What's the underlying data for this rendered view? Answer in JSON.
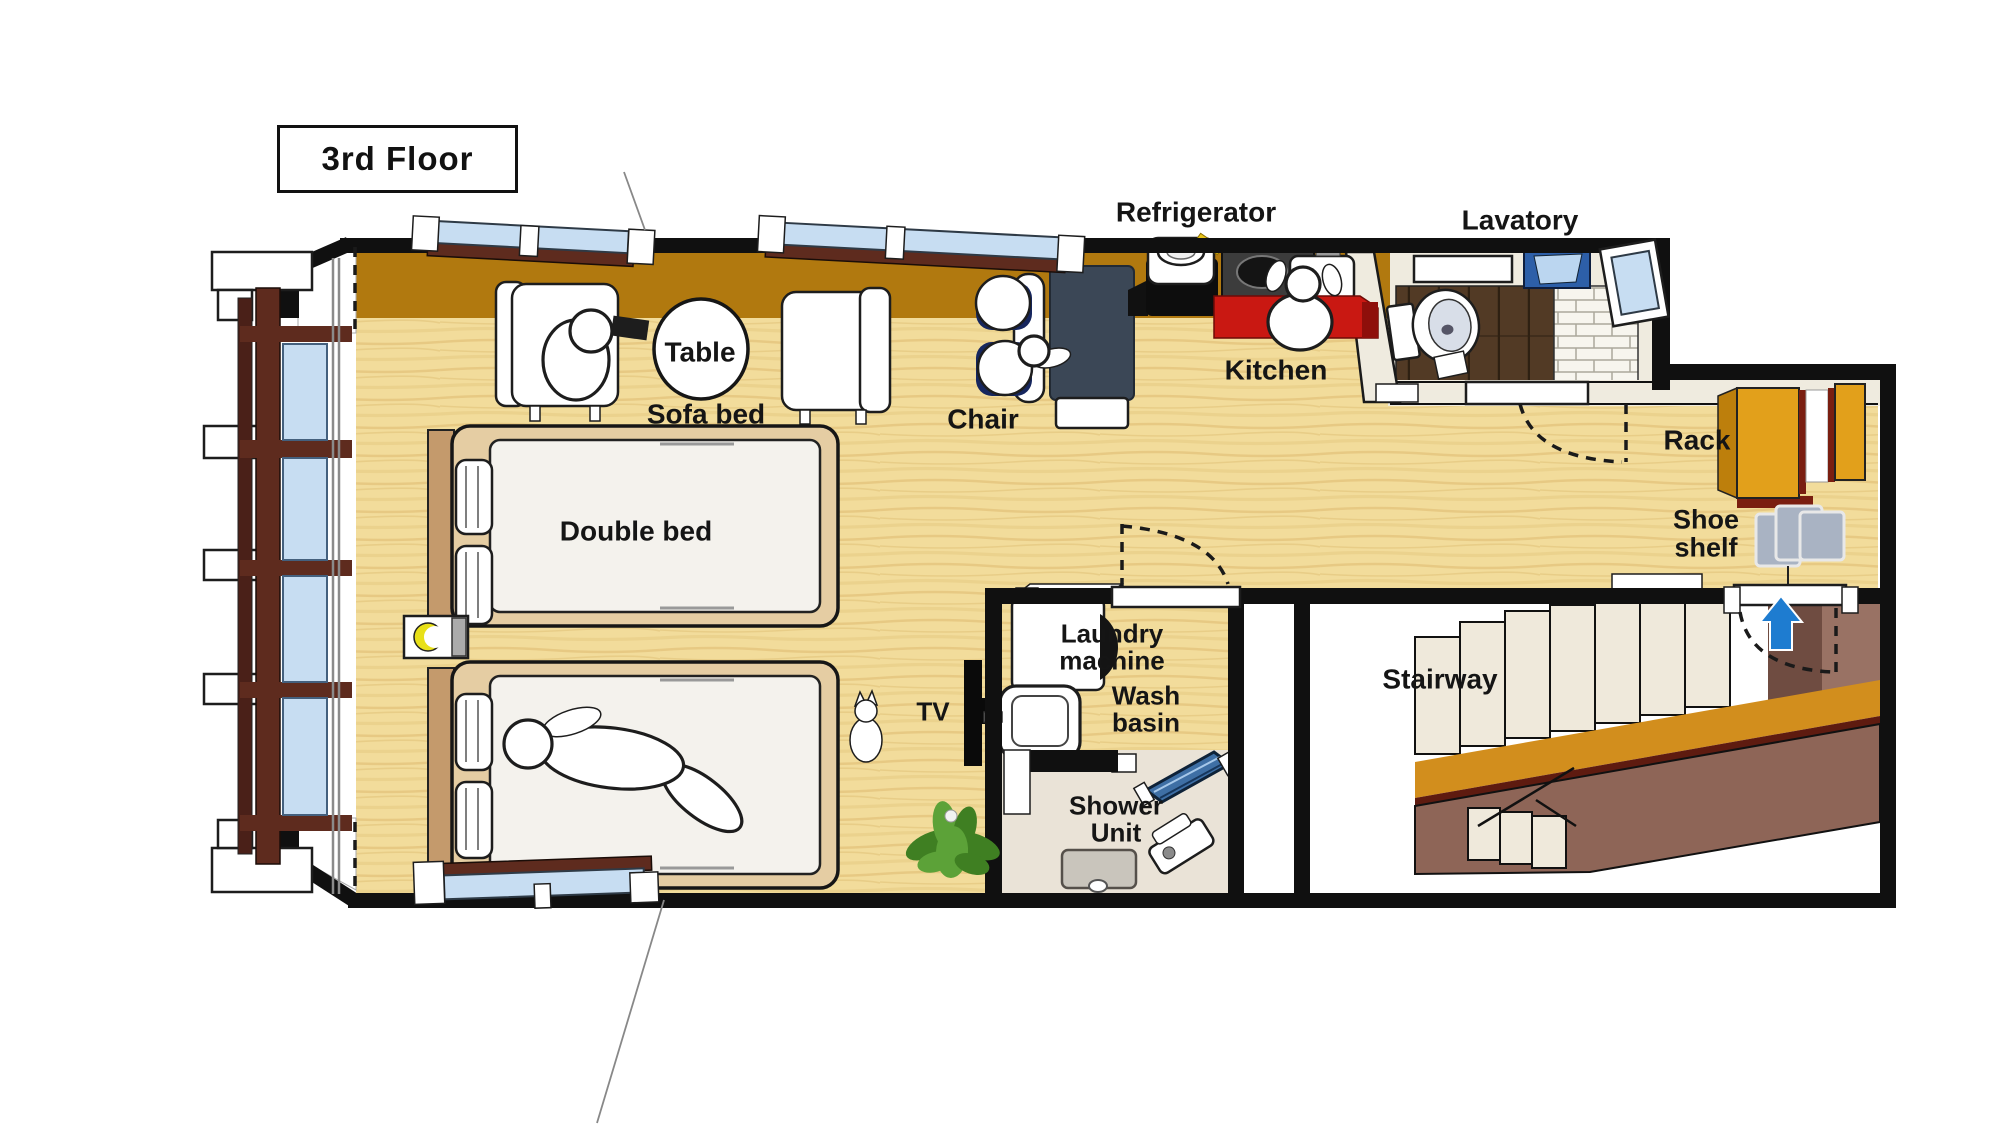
{
  "title": "3rd Floor",
  "colors": {
    "wall": "#101010",
    "wood": "#F2DC9B",
    "woodGrain": "#DDBA6E",
    "balcony": "#B1790F",
    "cream": "#EFEBDF",
    "lavFloor": "#523A25",
    "lavLine": "#2E2012",
    "brickBase": "#F7F5EE",
    "brickLine": "#ACA89B",
    "windowBlue": "#C7DDF2",
    "frameMaroon": "#5E2B1E",
    "counterRed": "#C91812",
    "counterRedDark": "#8E0F0B",
    "stoveGray": "#3C3C3C",
    "deskNavy": "#3B4756",
    "chairNavy": "#16265E",
    "rackOrange": "#E2A01B",
    "rackOrangeDark": "#BD7F0C",
    "rackEdge": "#7A1E10",
    "shoeGray": "#A9B3C3",
    "arrowBlue": "#1E7CD0",
    "stairOrange": "#D28E1D",
    "stairStripe": "#5E1B10",
    "stairBrown": "#8E6557",
    "landingDark": "#6F4C41",
    "landingLight": "#997264",
    "stepCream": "#EFE9DB",
    "bedTan": "#E5CDA3",
    "bedHead": "#C49A6C",
    "mattress": "#F4F2ED",
    "showerFloor": "#EAE3D7",
    "showerGlass": "#3E6FA5",
    "trayGray": "#C9C5BC",
    "plantDark": "#3F7F22",
    "plantLight": "#5CA238",
    "moonYellow": "#E8E018",
    "labelColor": "#151515"
  },
  "labels": [
    {
      "id": "refrigerator",
      "text": "Refrigerator",
      "x": 1196,
      "y": 212,
      "size": 28
    },
    {
      "id": "lavatory",
      "text": "Lavatory",
      "x": 1520,
      "y": 220,
      "size": 28
    },
    {
      "id": "table",
      "text": "Table",
      "x": 700,
      "y": 352,
      "size": 28
    },
    {
      "id": "sofa-bed",
      "text": "Sofa bed",
      "x": 706,
      "y": 414,
      "size": 28
    },
    {
      "id": "chair",
      "text": "Chair",
      "x": 983,
      "y": 419,
      "size": 28
    },
    {
      "id": "kitchen",
      "text": "Kitchen",
      "x": 1276,
      "y": 370,
      "size": 28
    },
    {
      "id": "rack",
      "text": "Rack",
      "x": 1697,
      "y": 440,
      "size": 28
    },
    {
      "id": "shoe-shelf",
      "text": "Shoe\nshelf",
      "x": 1706,
      "y": 534,
      "size": 27
    },
    {
      "id": "double-bed",
      "text": "Double bed",
      "x": 636,
      "y": 531,
      "size": 28
    },
    {
      "id": "laundry-machine",
      "text": "Laundry\nmachine",
      "x": 1112,
      "y": 648,
      "size": 26
    },
    {
      "id": "wash-basin",
      "text": "Wash\nbasin",
      "x": 1146,
      "y": 710,
      "size": 26
    },
    {
      "id": "tv",
      "text": "TV",
      "x": 933,
      "y": 712,
      "size": 26
    },
    {
      "id": "stairway",
      "text": "Stairway",
      "x": 1440,
      "y": 679,
      "size": 28
    },
    {
      "id": "shower-unit",
      "text": "Shower\nUnit",
      "x": 1116,
      "y": 820,
      "size": 26
    }
  ]
}
